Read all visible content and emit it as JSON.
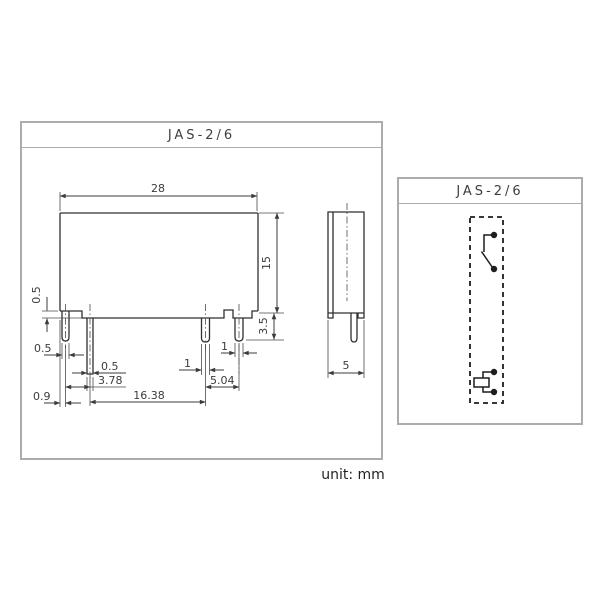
{
  "main_panel": {
    "title": "JAS-2/6"
  },
  "schematic_panel": {
    "title": "JAS-2/6"
  },
  "unit_label": "unit: mm",
  "dims": {
    "body_width": "28",
    "body_height": "15",
    "pin_protrusion": "3.5",
    "standoff_step": "0.5",
    "pin1_width": "0.5",
    "pin2_width": "0.5",
    "pitch_p1_p2": "3.78",
    "pin4_width": "1",
    "pin3_width": "1",
    "pitch_p3_p4": "5.04",
    "pitch_p2_p3": "16.38",
    "edge_to_pin1": "0.9",
    "side_depth": "5"
  },
  "colors": {
    "line": "#3a3d3d",
    "panel_border": "#aaadad",
    "schematic_ink": "#1c1e1e",
    "background": "#ffffff"
  }
}
